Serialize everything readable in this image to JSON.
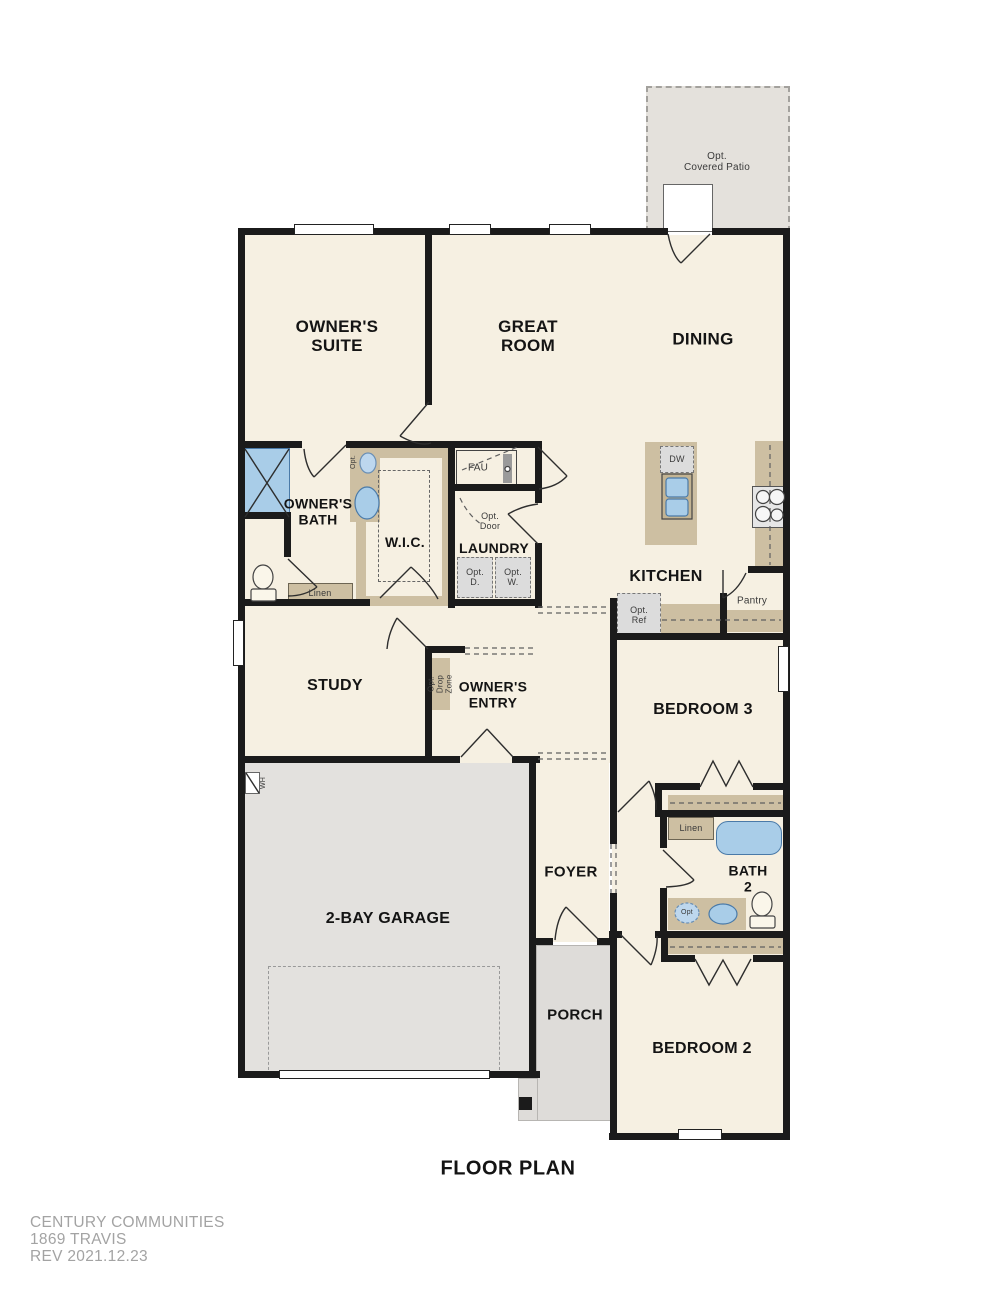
{
  "title": "FLOOR PLAN",
  "footer": {
    "company": "CENTURY COMMUNITIES",
    "plan_name": "1869 TRAVIS",
    "revision": "REV  2021.12.23"
  },
  "rooms": {
    "owners_suite": "OWNER'S\nSUITE",
    "great_room": "GREAT\nROOM",
    "dining": "DINING",
    "owners_bath": "OWNER'S\nBATH",
    "wic": "W.I.C.",
    "laundry": "LAUNDRY",
    "kitchen": "KITCHEN",
    "study": "STUDY",
    "owners_entry": "OWNER'S\nENTRY",
    "bedroom_3": "BEDROOM 3",
    "garage": "2-BAY GARAGE",
    "foyer": "FOYER",
    "bath_2": "BATH\n2",
    "porch": "PORCH",
    "bedroom_2": "BEDROOM 2",
    "opt_covered_patio": "Opt.\nCovered Patio"
  },
  "features": {
    "fau": "FAU",
    "opt_door": "Opt.\nDoor",
    "opt_dryer": "Opt.\nD.",
    "opt_washer": "Opt.\nW.",
    "dishwasher": "DW",
    "pantry": "Pantry",
    "opt_ref": "Opt.\nRef",
    "linen_owners": "Linen",
    "linen_hall": "Linen",
    "opt_drop_zone": "Opt.\nDrop\nZone",
    "water_heater": "WH",
    "opt_sink": "Opt.",
    "opt_sink_bath2": "Opt"
  },
  "colors": {
    "wall": "#1b1b1b",
    "floor": "#f6f0e2",
    "garage_floor": "#e3e1de",
    "patio_floor": "#e4e1dc",
    "porch_floor": "#dedcd9",
    "cabinet_tan": "#cdbfa2",
    "fixture_blue": "#a9cde8",
    "fixture_blue_border": "#4a7aa8",
    "optional_gray": "#dcdcdc",
    "footer_text": "#a3a3a3"
  }
}
